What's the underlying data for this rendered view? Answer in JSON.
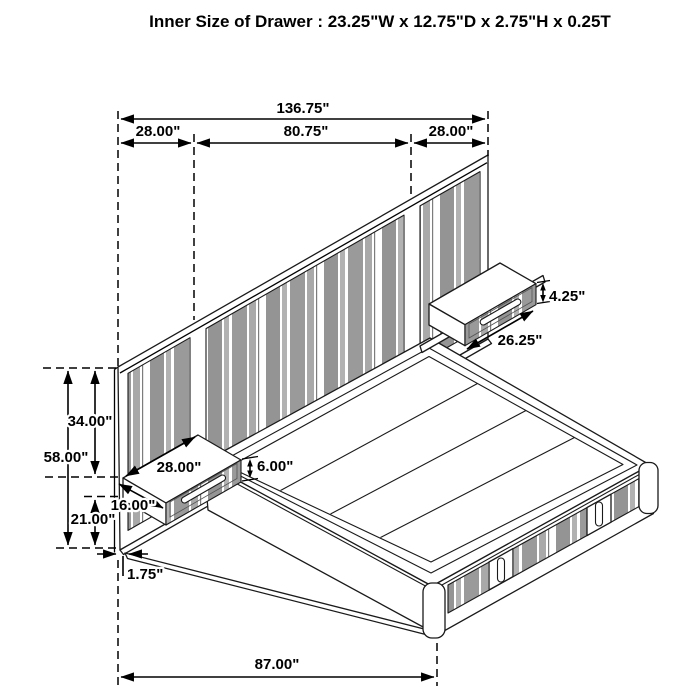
{
  "title": "Inner Size of Drawer : 23.25\"W x 12.75\"D x 2.75\"H x 0.25T",
  "dimensions": {
    "overall_width": "136.75\"",
    "left_section_width": "28.00\"",
    "center_section_width": "80.75\"",
    "right_section_width": "28.00\"",
    "right_nightstand_height": "4.25\"",
    "right_nightstand_width": "26.25\"",
    "upper_height": "34.00\"",
    "headboard_height": "58.00\"",
    "left_nightstand_width": "28.00\"",
    "left_nightstand_height": "6.00\"",
    "left_nightstand_depth": "16.00\"",
    "lower_height": "21.00\"",
    "panel_thickness": "1.75\"",
    "bed_length": "87.00\""
  },
  "colors": {
    "line": "#000000",
    "stripe_gray": "#9a9a9a",
    "background": "#ffffff"
  }
}
